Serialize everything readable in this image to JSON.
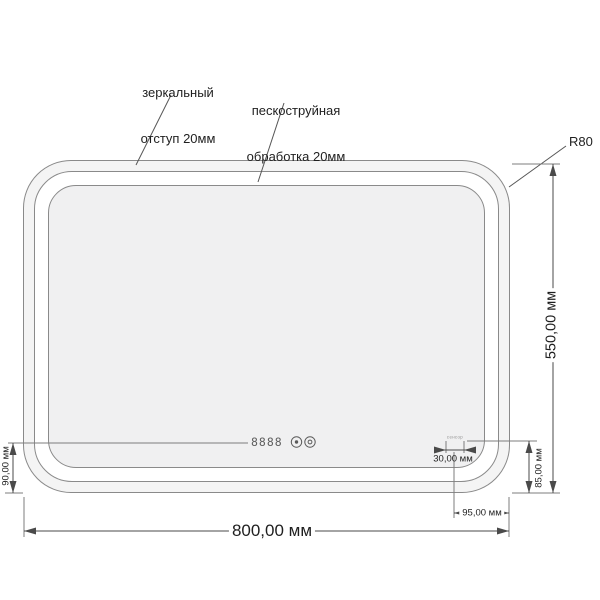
{
  "drawing": {
    "type": "mirror technical drawing",
    "callouts": {
      "mirror_offset_line1": "зеркальный",
      "mirror_offset_line2": "отступ 20мм",
      "sandblast_line1": "пескоструйная",
      "sandblast_line2": "обработка 20мм",
      "corner_radius": "R80"
    },
    "dimensions": {
      "overall_width": "800,00 мм",
      "overall_height": "550,00 мм",
      "display_bottom_offset": "90,00 мм",
      "sensor_width": "30,00 мм",
      "sensor_bottom_offset": "85,00 мм",
      "sensor_right_offset": "95,00 мм"
    },
    "display": {
      "digits": "8888"
    },
    "sensor": {
      "marking": "сенсор"
    }
  },
  "colors": {
    "outline": "#8a8a8a",
    "dim": "#4a4a4a",
    "text": "#1f1f1f",
    "mirror-fill": "#f0f0f1",
    "frame-fill": "#f4f4f4",
    "band-fill": "#ffffff",
    "digits": "#5f5f5f"
  }
}
